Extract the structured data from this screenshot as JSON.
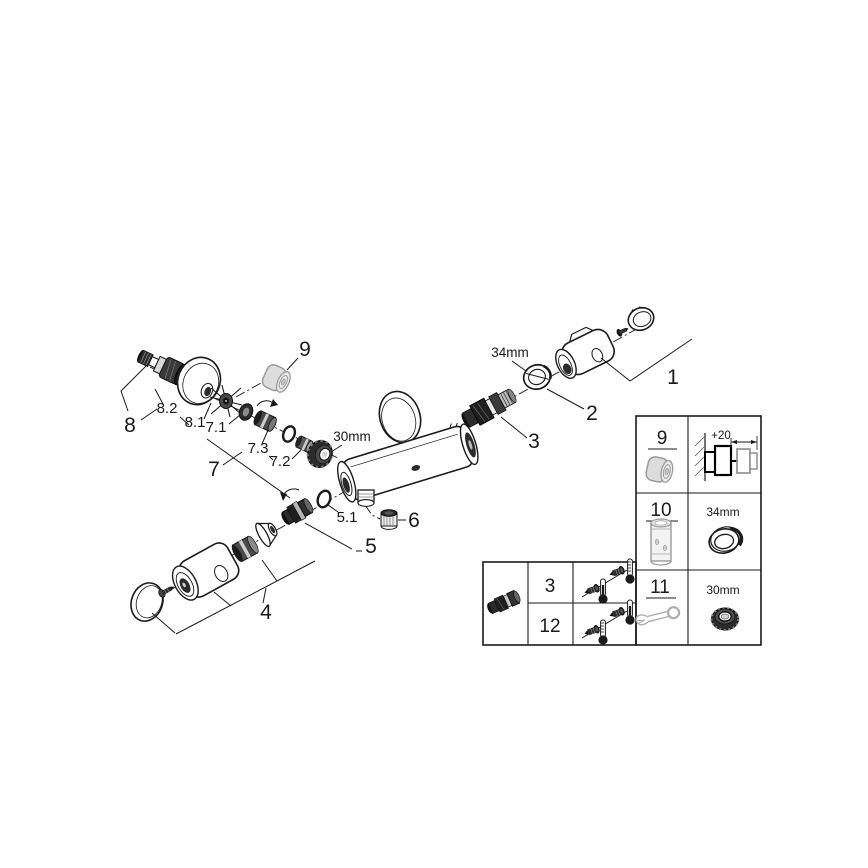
{
  "colors": {
    "background": "#ffffff",
    "line": "#1a1a1a",
    "grey_part": "#9a9a9a"
  },
  "callouts": {
    "part_1": "1",
    "part_2": "2",
    "part_3": "3",
    "part_4": "4",
    "part_5": "5",
    "part_6": "6",
    "part_7": "7",
    "part_8": "8",
    "part_9": "9",
    "sub_5_1": "5.1",
    "sub_7_1": "7.1",
    "sub_7_2": "7.2",
    "sub_7_3": "7.3",
    "sub_8_1": "8.1",
    "sub_8_2": "8.2",
    "dim_30mm": "30mm",
    "dim_34mm": "34mm"
  },
  "adjustment_table": {
    "rows": [
      {
        "ref": "3"
      },
      {
        "ref": "12"
      }
    ]
  },
  "accessory_table": {
    "rows": [
      {
        "ref": "9",
        "dim": "+20"
      },
      {
        "ref": "10",
        "dim": "34mm"
      },
      {
        "ref": "11",
        "dim": "30mm"
      }
    ]
  }
}
